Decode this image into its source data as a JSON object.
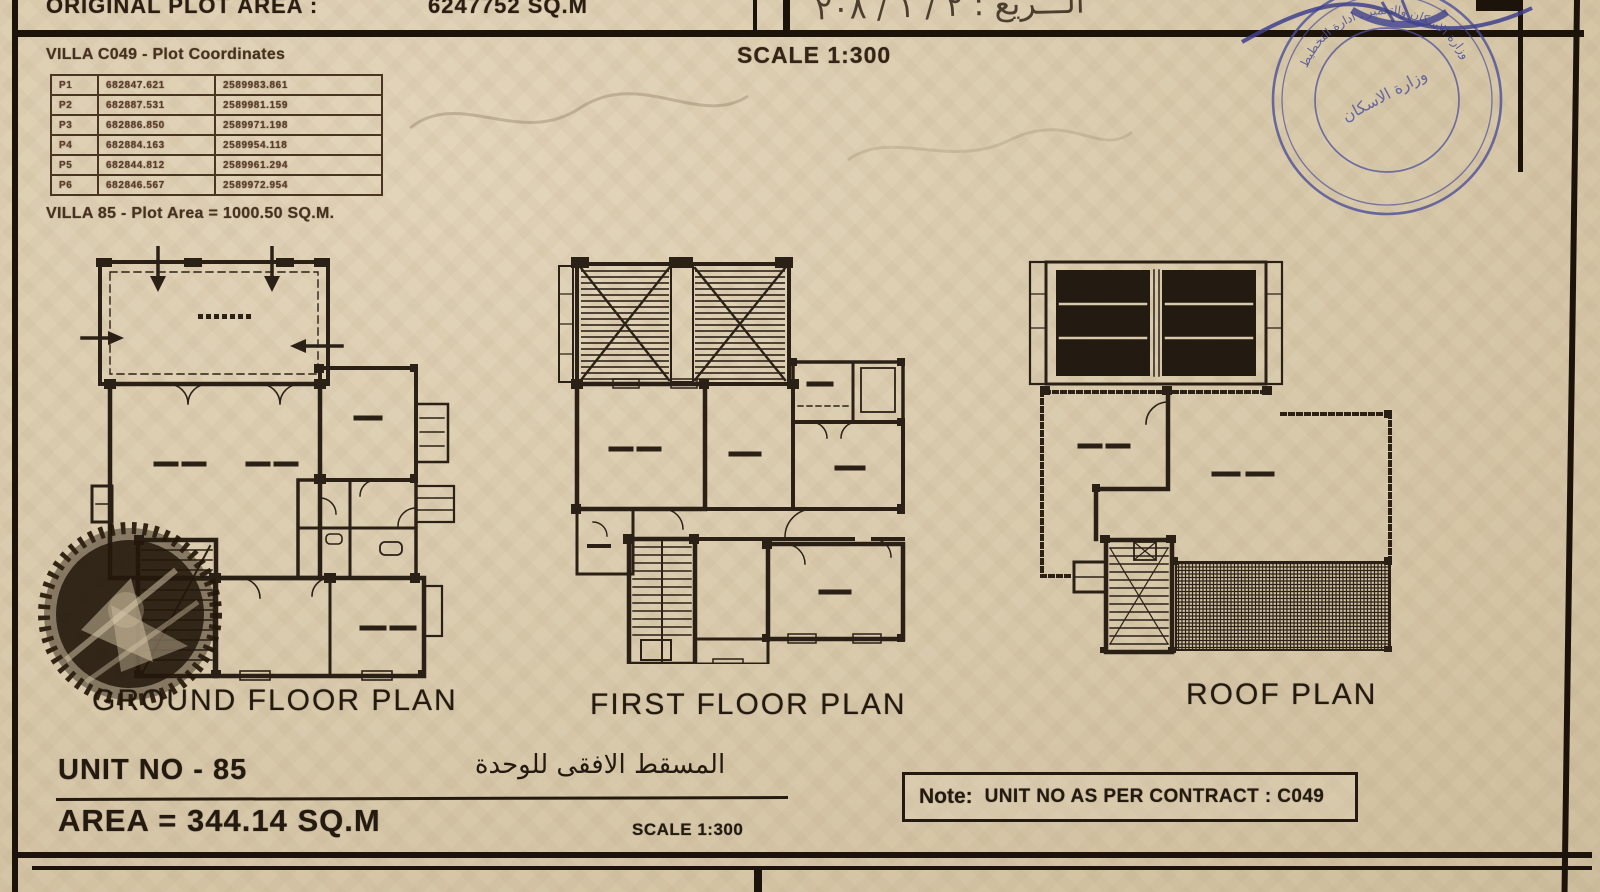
{
  "document": {
    "header": {
      "plot_area_label": "ORIGINAL PLOT AREA :",
      "plot_area_value": "6247752 SQ.M",
      "handwriting": "الـــريع : ٢ / ١ / ٢٠٨"
    },
    "coordinates": {
      "title": "VILLA  C049 - Plot Coordinates",
      "rows": [
        {
          "p": "P1",
          "e": "682847.621",
          "n": "2589983.861"
        },
        {
          "p": "P2",
          "e": "682887.531",
          "n": "2589981.159"
        },
        {
          "p": "P3",
          "e": "682886.850",
          "n": "2589971.198"
        },
        {
          "p": "P4",
          "e": "682884.163",
          "n": "2589954.118"
        },
        {
          "p": "P5",
          "e": "682844.812",
          "n": "2589961.294"
        },
        {
          "p": "P6",
          "e": "682846.567",
          "n": "2589972.954"
        }
      ],
      "area_line": "VILLA  85 - Plot Area = 1000.50 SQ.M."
    },
    "scale_top": "SCALE 1:300",
    "plans": {
      "ground": "GROUND FLOOR PLAN",
      "first": "FIRST FLOOR PLAN",
      "roof": "ROOF PLAN"
    },
    "title_block": {
      "unit_no": "UNIT NO - 85",
      "arabic_title": "المسقط الافقى للوحدة",
      "area": "AREA = 344.14 SQ.M",
      "scale": "SCALE 1:300"
    },
    "note": {
      "label": "Note:",
      "text": "UNIT NO AS PER CONTRACT : C049"
    },
    "stamp": {
      "ring_text": "وزارة الاسكان والتعمير ـ ادارة التخطيط",
      "center_text": "وزارة الاسكان"
    },
    "colors": {
      "paper": "#d8c9ab",
      "ink": "#241a10",
      "stamp_blue": "#4c4f99"
    }
  }
}
